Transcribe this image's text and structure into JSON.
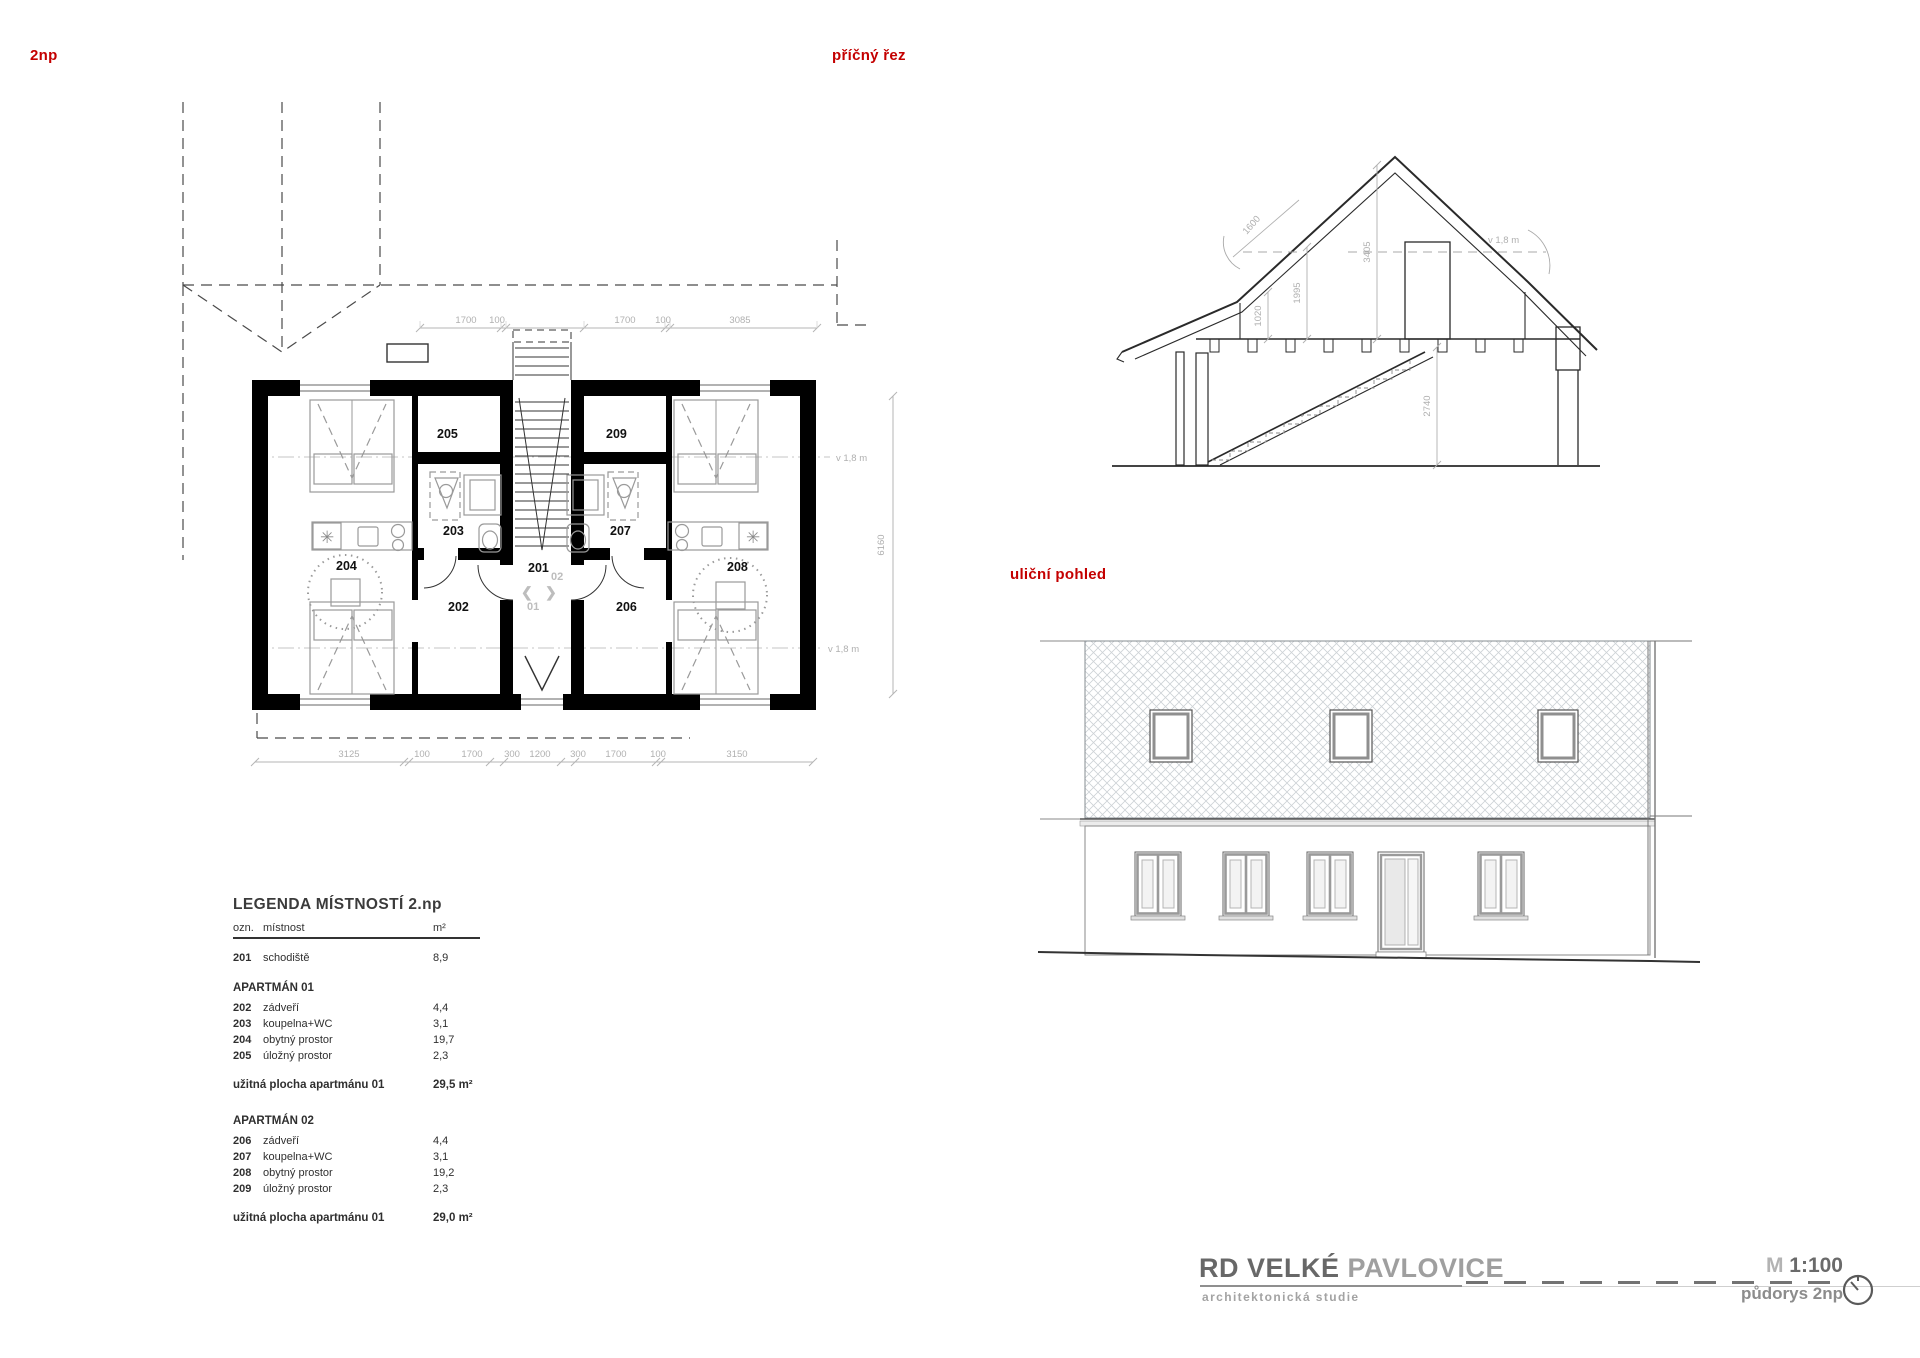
{
  "colors": {
    "accent_red": "#c40000",
    "wall_black": "#000000",
    "dim_gray": "#b0b0b0",
    "furniture_gray": "#9a9a9a",
    "title_gray": "#6f6f6f",
    "hatch_gray": "#cdd2d6"
  },
  "plan": {
    "label": "2np",
    "rooms": [
      "201",
      "202",
      "203",
      "204",
      "205",
      "206",
      "207",
      "208",
      "209"
    ],
    "unit_marks": {
      "upper": "02",
      "lower": "01"
    },
    "arrows": {
      "left": "❮",
      "right": "❯"
    },
    "dim_top": [
      "1700",
      "100",
      "1700",
      "100",
      "3085"
    ],
    "dim_bottom": [
      "3125",
      "100",
      "1700",
      "300",
      "1200",
      "300",
      "1700",
      "100",
      "3150"
    ],
    "dim_side": "6160",
    "headroom": "v 1,8 m"
  },
  "section": {
    "label": "příčný řez",
    "dims": [
      "1600",
      "1020",
      "1995",
      "3405",
      "2740"
    ],
    "headroom": "v 1,8 m"
  },
  "elevation": {
    "label": "uliční pohled"
  },
  "legend": {
    "title": "LEGENDA MÍSTNOSTÍ 2.np",
    "columns": {
      "num": "ozn.",
      "name": "místnost",
      "area": "m²"
    },
    "rows": [
      {
        "num": "201",
        "name": "schodiště",
        "area": "8,9"
      }
    ],
    "groups": [
      {
        "title": "APARTMÁN 01",
        "rows": [
          {
            "num": "202",
            "name": "zádveří",
            "area": "4,4"
          },
          {
            "num": "203",
            "name": "koupelna+WC",
            "area": "3,1"
          },
          {
            "num": "204",
            "name": "obytný prostor",
            "area": "19,7"
          },
          {
            "num": "205",
            "name": "úložný prostor",
            "area": "2,3"
          }
        ],
        "total_label": "užitná plocha  apartmánu 01",
        "total_value": "29,5 m²"
      },
      {
        "title": "APARTMÁN 02",
        "rows": [
          {
            "num": "206",
            "name": "zádveří",
            "area": "4,4"
          },
          {
            "num": "207",
            "name": "koupelna+WC",
            "area": "3,1"
          },
          {
            "num": "208",
            "name": "obytný prostor",
            "area": "19,2"
          },
          {
            "num": "209",
            "name": "úložný prostor",
            "area": "2,3"
          }
        ],
        "total_label": "užitná plocha  apartmánu 01",
        "total_value": "29,0 m²"
      }
    ]
  },
  "titleblock": {
    "title_left": "RD VELKÉ",
    "title_right": "PAVLOVICE",
    "subtitle": "architektonická studie",
    "scale_prefix": "M",
    "scale_value": "1:100",
    "sheet": "půdorys 2np"
  }
}
